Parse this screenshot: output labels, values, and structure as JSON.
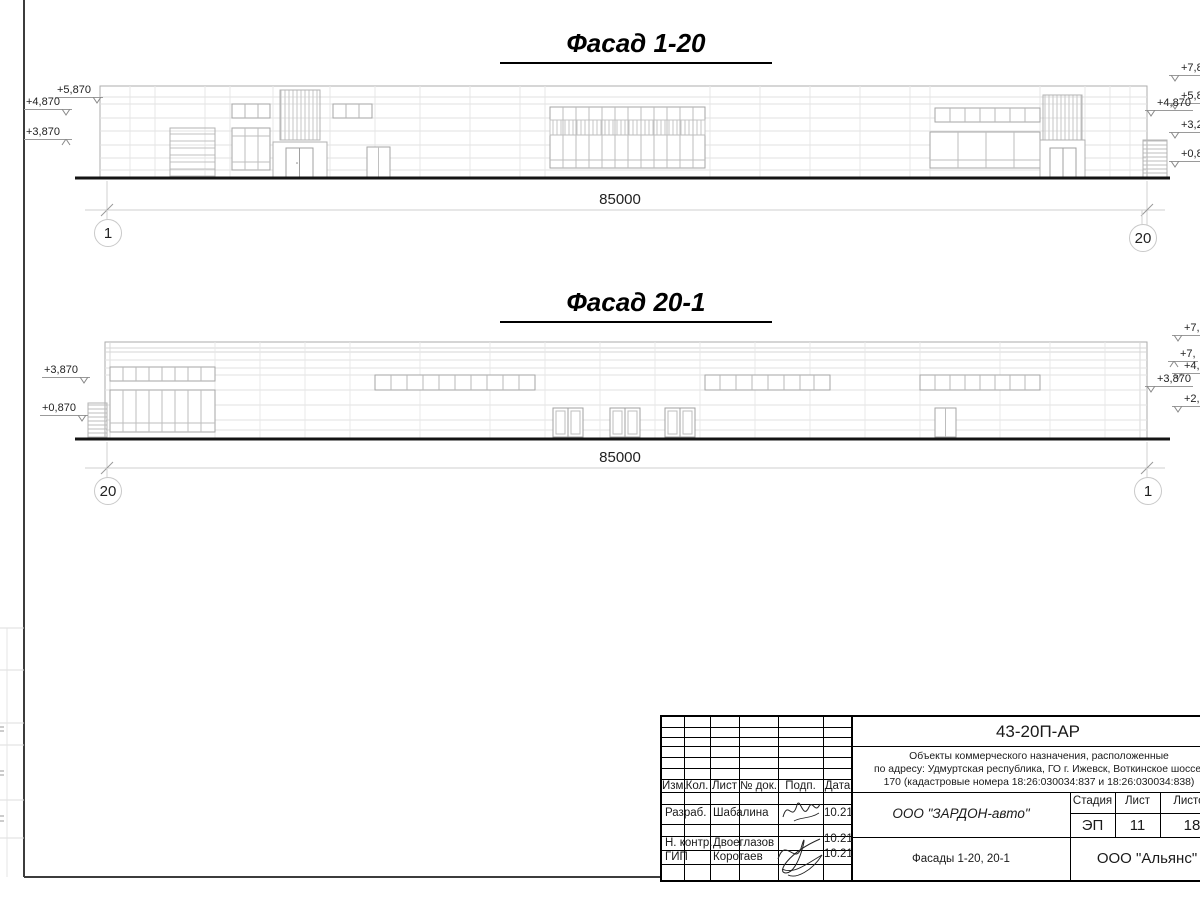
{
  "facade1": {
    "title": "Фасад 1-20",
    "dimension": "85000",
    "axis_left": "1",
    "axis_right": "20",
    "levels_left": [
      "+5,870",
      "+4,870",
      "+3,870"
    ],
    "levels_right": [
      "+7,87",
      "+5,87",
      "+4,870",
      "+3,27",
      "+0,87"
    ]
  },
  "facade2": {
    "title": "Фасад 20-1",
    "dimension": "85000",
    "axis_left": "20",
    "axis_right": "1",
    "levels_left": [
      "+3,870",
      "+0,870"
    ],
    "levels_right": [
      "+7,8",
      "+7,",
      "+4,8",
      "+3,870",
      "+2,1"
    ]
  },
  "titleblock": {
    "doc_number": "43-20П-АР",
    "project_desc_line1": "Объекты коммерческого назначения, расположенные",
    "project_desc_line2": "по адресу: Удмуртская республика, ГО г. Ижевск, Воткинское шоссе,",
    "project_desc_line3": "170 (кадастровые номера 18:26:030034:837 и 18:26:030034:838)",
    "client": "ООО \"ЗАРДОН-авто\"",
    "sheet_title": "Фасады 1-20, 20-1",
    "organization": "ООО \"Альянс\"",
    "stage_label": "Стадия",
    "sheet_label": "Лист",
    "sheets_label": "Листов",
    "stage": "ЭП",
    "sheet_no": "11",
    "sheets_total": "18",
    "col_izm": "Изм.",
    "col_kol": "Кол.",
    "col_list": "Лист",
    "col_doc": "№ док.",
    "col_podp": "Подп.",
    "col_data": "Дата",
    "rows": [
      {
        "role": "Разраб.",
        "name": "Шабалина",
        "date": "10.21"
      },
      {
        "role": "Н. контр.",
        "name": "Двоеглазов",
        "date": "10.21"
      },
      {
        "role": "ГИП",
        "name": "Коротаев",
        "date": "10.21"
      }
    ]
  }
}
